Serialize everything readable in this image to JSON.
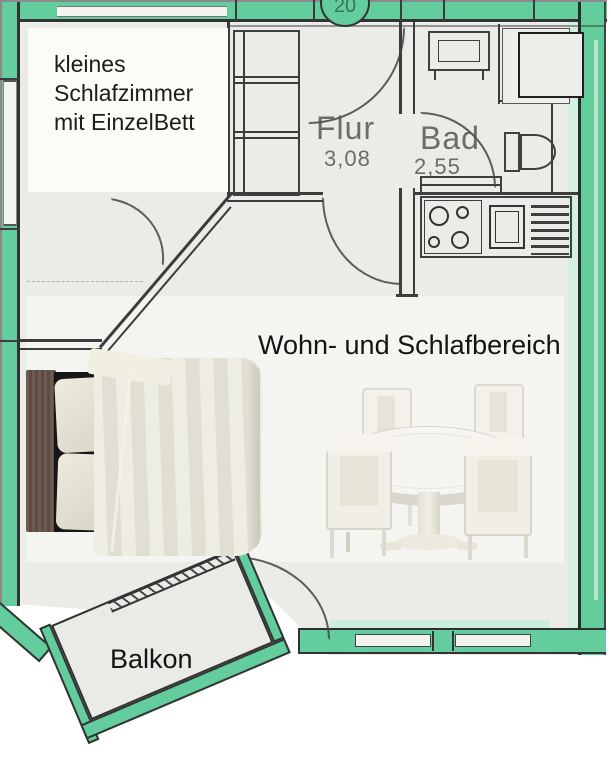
{
  "plan": {
    "unit_badge": "20",
    "rooms": {
      "bedroom": {
        "label_lines": [
          "kleines",
          "Schlafzimmer",
          "mit EinzelBett"
        ]
      },
      "hall": {
        "name": "Flur",
        "dimension": "3,08"
      },
      "bath": {
        "name": "Bad",
        "dimension": "2,55"
      },
      "living": {
        "name": "Wohn- und Schlafbereich"
      },
      "balcony": {
        "name": "Balkon"
      }
    },
    "colors": {
      "wall_highlight": "#63cd9d",
      "paper": "#ebebe7",
      "plan_line": "#3c3c3c",
      "overlay_white": "#f4f4f1",
      "label_text": "#1c1c1c",
      "plan_text": "#565656"
    },
    "symbols": [
      "entrance-door-arc",
      "bedroom-door-arc",
      "bath-door-arc",
      "living-door-arc",
      "balcony-door-arc",
      "wardrobe",
      "bath-sink",
      "shower",
      "toilet",
      "stove-4-burners",
      "kitchen-sink",
      "dish-rack"
    ],
    "furniture_photos": [
      "double-bed-top-view",
      "round-dining-table-with-4-chairs"
    ]
  }
}
